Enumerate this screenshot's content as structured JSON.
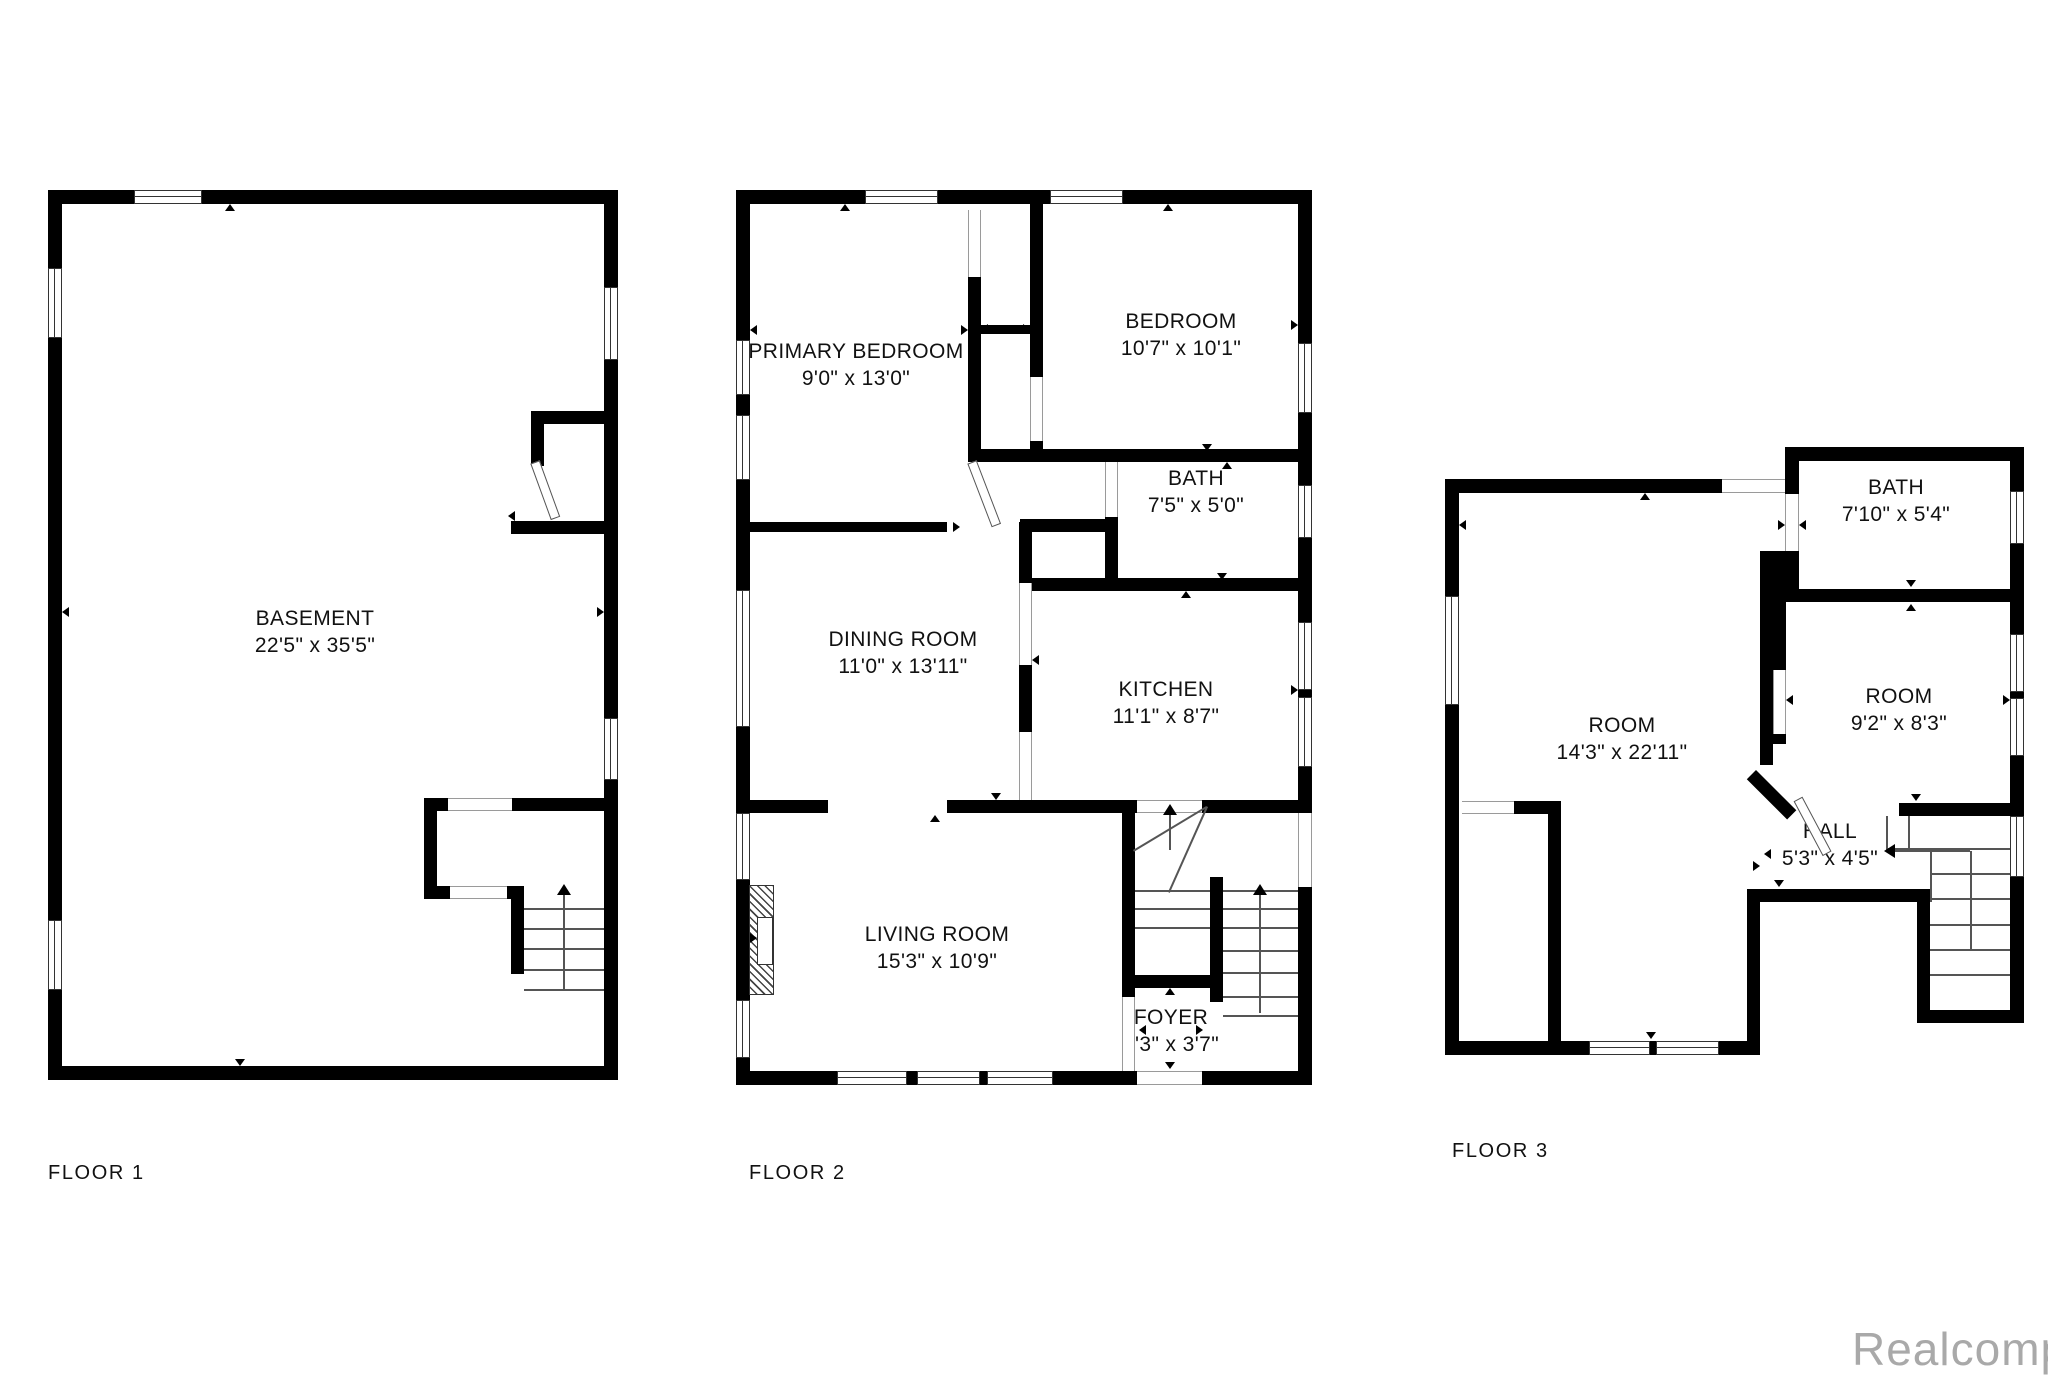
{
  "floors": [
    {
      "title": "FLOOR 1",
      "rooms": [
        {
          "name": "BASEMENT",
          "dims": "22'5\" x 35'5\""
        }
      ]
    },
    {
      "title": "FLOOR 2",
      "rooms": [
        {
          "name": "PRIMARY BEDROOM",
          "dims": "9'0\" x 13'0\""
        },
        {
          "name": "BEDROOM",
          "dims": "10'7\" x 10'1\""
        },
        {
          "name": "BATH",
          "dims": "7'5\" x 5'0\""
        },
        {
          "name": "DINING ROOM",
          "dims": "11'0\" x 13'11\""
        },
        {
          "name": "KITCHEN",
          "dims": "11'1\" x 8'7\""
        },
        {
          "name": "LIVING ROOM",
          "dims": "15'3\" x 10'9\""
        },
        {
          "name": "FOYER",
          "dims": "3'3\" x 3'7\""
        }
      ]
    },
    {
      "title": "FLOOR 3",
      "rooms": [
        {
          "name": "BATH",
          "dims": "7'10\" x 5'4\""
        },
        {
          "name": "ROOM",
          "dims": "14'3\" x 22'11\""
        },
        {
          "name": "ROOM",
          "dims": "9'2\" x 8'3\""
        },
        {
          "name": "HALL",
          "dims": "5'3\" x 4'5\""
        }
      ]
    }
  ],
  "watermark": "Realcomp",
  "colors": {
    "wall": "#000000",
    "background": "#ffffff",
    "watermark": "#a9a9a9"
  }
}
